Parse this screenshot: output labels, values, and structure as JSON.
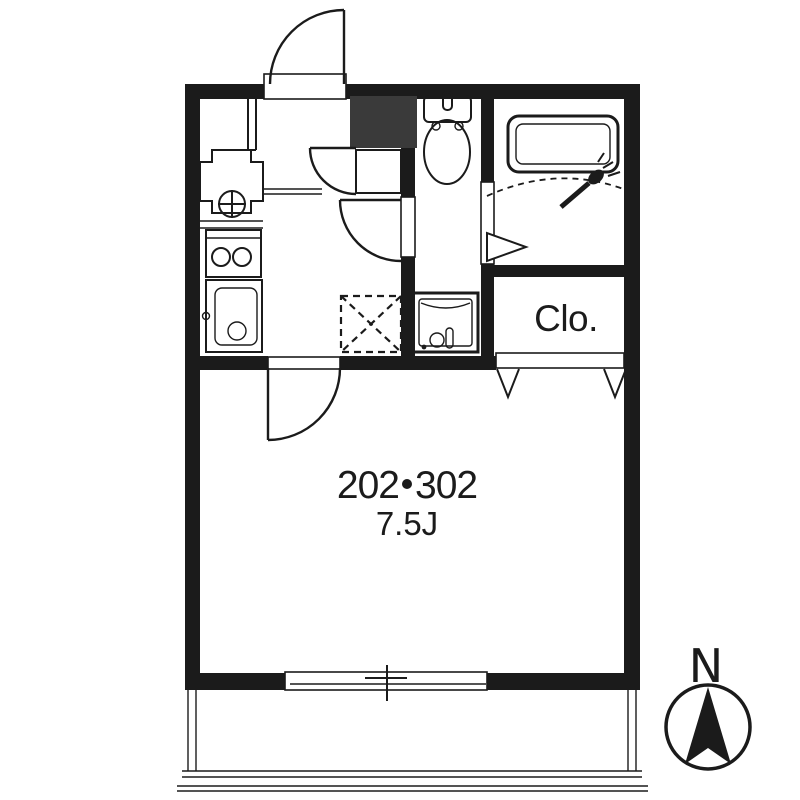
{
  "labels": {
    "unit": "202・302",
    "unit_left": "202",
    "unit_right": "302",
    "area": "7.5J",
    "closet": "Clo.",
    "compass_north": "N"
  },
  "colors": {
    "wall": "#1b1b1b",
    "line": "#1b1b1b",
    "shaft_fill": "#3a3a3a",
    "background": "#ffffff"
  },
  "fixtures": [
    "entrance-door",
    "washing-machine-pan",
    "gas-stove",
    "kitchen-sink",
    "refrigerator-space",
    "shoe-cabinet",
    "toilet",
    "wash-basin",
    "bathtub",
    "shower-head",
    "bathroom-folding-door",
    "washroom-door",
    "main-room-door",
    "closet",
    "closet-folding-door-marks",
    "sliding-window",
    "balcony-railing",
    "north-compass"
  ]
}
